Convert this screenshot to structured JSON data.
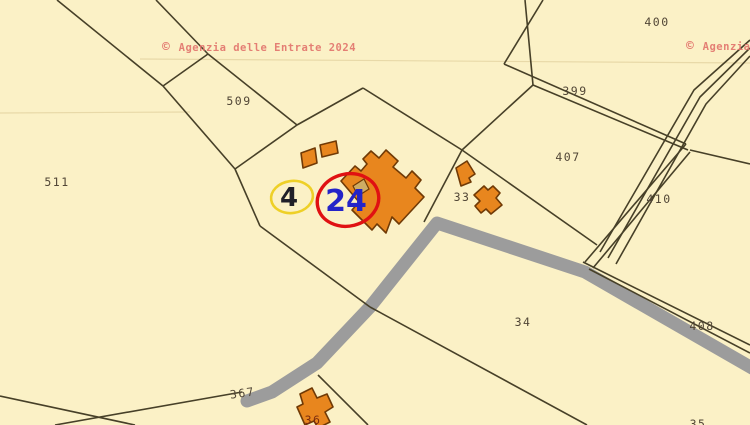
{
  "map": {
    "background": "#FBF1C6",
    "boundary_color": "#474028",
    "boundary_width": 1.6,
    "faint_line_color": "#E8D9A8",
    "label_color": "#514636",
    "building_label_color": "#7A2C0E",
    "watermark_color": "#E2736C",
    "watermark_symbol": "©",
    "watermarks": [
      {
        "name": "watermark-left",
        "text": "Agenzia delle Entrate 2024",
        "x": 162,
        "y": 51
      },
      {
        "name": "watermark-right",
        "text": "Agenzia delle Entrate 2024",
        "x": 686,
        "y": 50
      }
    ],
    "road": {
      "color": "#9C9C9C",
      "width": 13,
      "points": "247,401 272,392 317,363 370,307 437,223 585,272 752,368"
    },
    "faint_lines": [
      "140,59 750,63",
      "0,113 190,112"
    ],
    "boundaries": [
      "57,0 163,86",
      "163,86 235,169",
      "156,0 208,54",
      "208,54 163,86",
      "208,54 297,125",
      "363,88 297,125",
      "297,125 235,169",
      "235,169 260,226",
      "260,226 370,307",
      "370,307 587,425",
      "363,88 462,150",
      "462,150 533,85",
      "462,150 424,222",
      "462,150 597,245",
      "525,0 533,85",
      "543,0 504,64",
      "504,64 686,144",
      "533,85 688,150",
      "686,144 585,262",
      "690,152 593,268",
      "690,150 750,164",
      "750,40 694,90 600,252",
      "750,48 700,97 608,258",
      "750,56 706,104 616,264",
      "583,262 750,345",
      "589,269 750,353",
      "318,375 368,425",
      "55,425 242,392",
      "0,396 135,425"
    ],
    "buildings": {
      "fill": "#E8861E",
      "stroke": "#703A06",
      "stroke_width": 1.6,
      "shapes": [
        "M341,181 L355,166 L361,171 L367,164 L363,159 L371,151 L379,158 L386,150 L398,161 L393,167 L406,178 L412,171 L421,180 L415,188 L424,197 L399,224 L392,217 L386,233 L377,224 L372,230 L352,210 L359,202 Z",
        "M301,153 L315,148 L317,163 L303,168 Z",
        "M320,145 L336,141 L338,153 L322,157 Z",
        "M456,168 L467,161 L475,174 L469,178 L471,182 L461,186 Z",
        "M474,195 L484,186 L488,190 L493,186 L500,193 L496,198 L502,205 L491,214 L486,209 L481,213 L475,206 L480,201 Z",
        "M300,394 L312,388 L317,398 L327,394 L333,407 L325,412 L330,422 L318,428 L314,421 L305,425 L297,407 L303,404 Z"
      ],
      "shed": {
        "fill": "#CEAC64",
        "shape": "M353,186 L364,179 L369,189 L358,196 Z"
      }
    },
    "labels": [
      {
        "text": "400",
        "x": 657,
        "y": 26
      },
      {
        "text": "399",
        "x": 575,
        "y": 95
      },
      {
        "text": "407",
        "x": 568,
        "y": 161
      },
      {
        "text": "410",
        "x": 659,
        "y": 203
      },
      {
        "text": "408",
        "x": 702,
        "y": 330
      },
      {
        "text": "34",
        "x": 523,
        "y": 326
      },
      {
        "text": "33",
        "x": 462,
        "y": 201
      },
      {
        "text": "509",
        "x": 239,
        "y": 105
      },
      {
        "text": "511",
        "x": 57,
        "y": 186
      },
      {
        "text": "367",
        "x": 243,
        "y": 397,
        "rot": -8
      },
      {
        "text": "36",
        "x": 313,
        "y": 424,
        "building": true
      },
      {
        "text": "35",
        "x": 698,
        "y": 428
      }
    ],
    "highlights": {
      "yellow": {
        "cx": 292,
        "cy": 197,
        "rx": 21,
        "ry": 16,
        "rot": -8,
        "stroke": "#EED027",
        "stroke_width": 2.6,
        "label": "4",
        "label_color": "#202028",
        "label_size": 26,
        "label_x": 289,
        "label_y": 206
      },
      "red": {
        "cx": 348,
        "cy": 200,
        "rx": 31,
        "ry": 26,
        "rot": -14,
        "stroke": "#E01112",
        "stroke_width": 3.4,
        "label": "24",
        "label_color": "#2424C8",
        "label_size": 30,
        "label_x": 346,
        "label_y": 211
      }
    }
  }
}
